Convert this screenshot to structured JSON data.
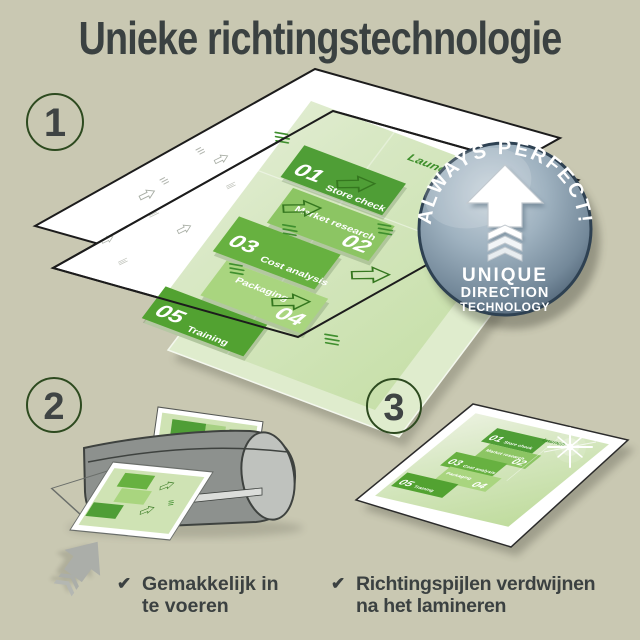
{
  "title": "Unieke richtingstechnologie",
  "check_glyph": "✔",
  "steps": [
    {
      "number": "1"
    },
    {
      "number": "2",
      "caption_line1": "Gemakkelijk in",
      "caption_line2": "te voeren"
    },
    {
      "number": "3",
      "caption_line1": "Richtingspijlen verdwijnen",
      "caption_line2": "na het lamineren"
    }
  ],
  "badge": {
    "arc_text": "ALWAYS PERFECT!",
    "line1": "UNIQUE",
    "line2": "DIRECTION",
    "line3": "TECHNOLOGY"
  },
  "document": {
    "launch": "Launch",
    "items": [
      {
        "num": "01",
        "label": "Store check"
      },
      {
        "num": "02",
        "label": "Market research"
      },
      {
        "num": "03",
        "label": "Cost analysis"
      },
      {
        "num": "04",
        "label": "Packaging"
      },
      {
        "num": "05",
        "label": "Training"
      }
    ]
  },
  "colors": {
    "background": "#c9c8b2",
    "heading_text": "#3a4141",
    "step_circle_outline": "#2d4a1f",
    "green_dark": "#4f9e36",
    "green_mid": "#8cc563",
    "green_mid_dark": "#67b140",
    "green_light": "#a9d57f",
    "green_pale": "#cfe3b4",
    "badge_steel": "#8da3b3",
    "laminator_gray": "#8d918e",
    "arrow_gray": "#abaea9"
  }
}
